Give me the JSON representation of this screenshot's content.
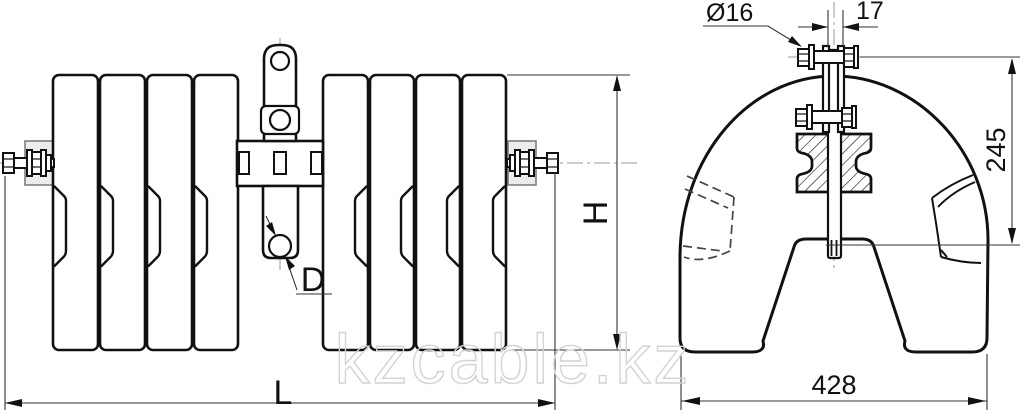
{
  "watermark": {
    "text": "kzcable.kz"
  },
  "front_view": {
    "dim_height_label": "H",
    "dim_length_label": "L",
    "dim_hole_label": "D"
  },
  "side_view": {
    "dim_bolt_diameter_label": "Ø16",
    "dim_plate_width_label": "17",
    "dim_saddle_height_label": "245",
    "dim_overall_width_label": "428"
  }
}
